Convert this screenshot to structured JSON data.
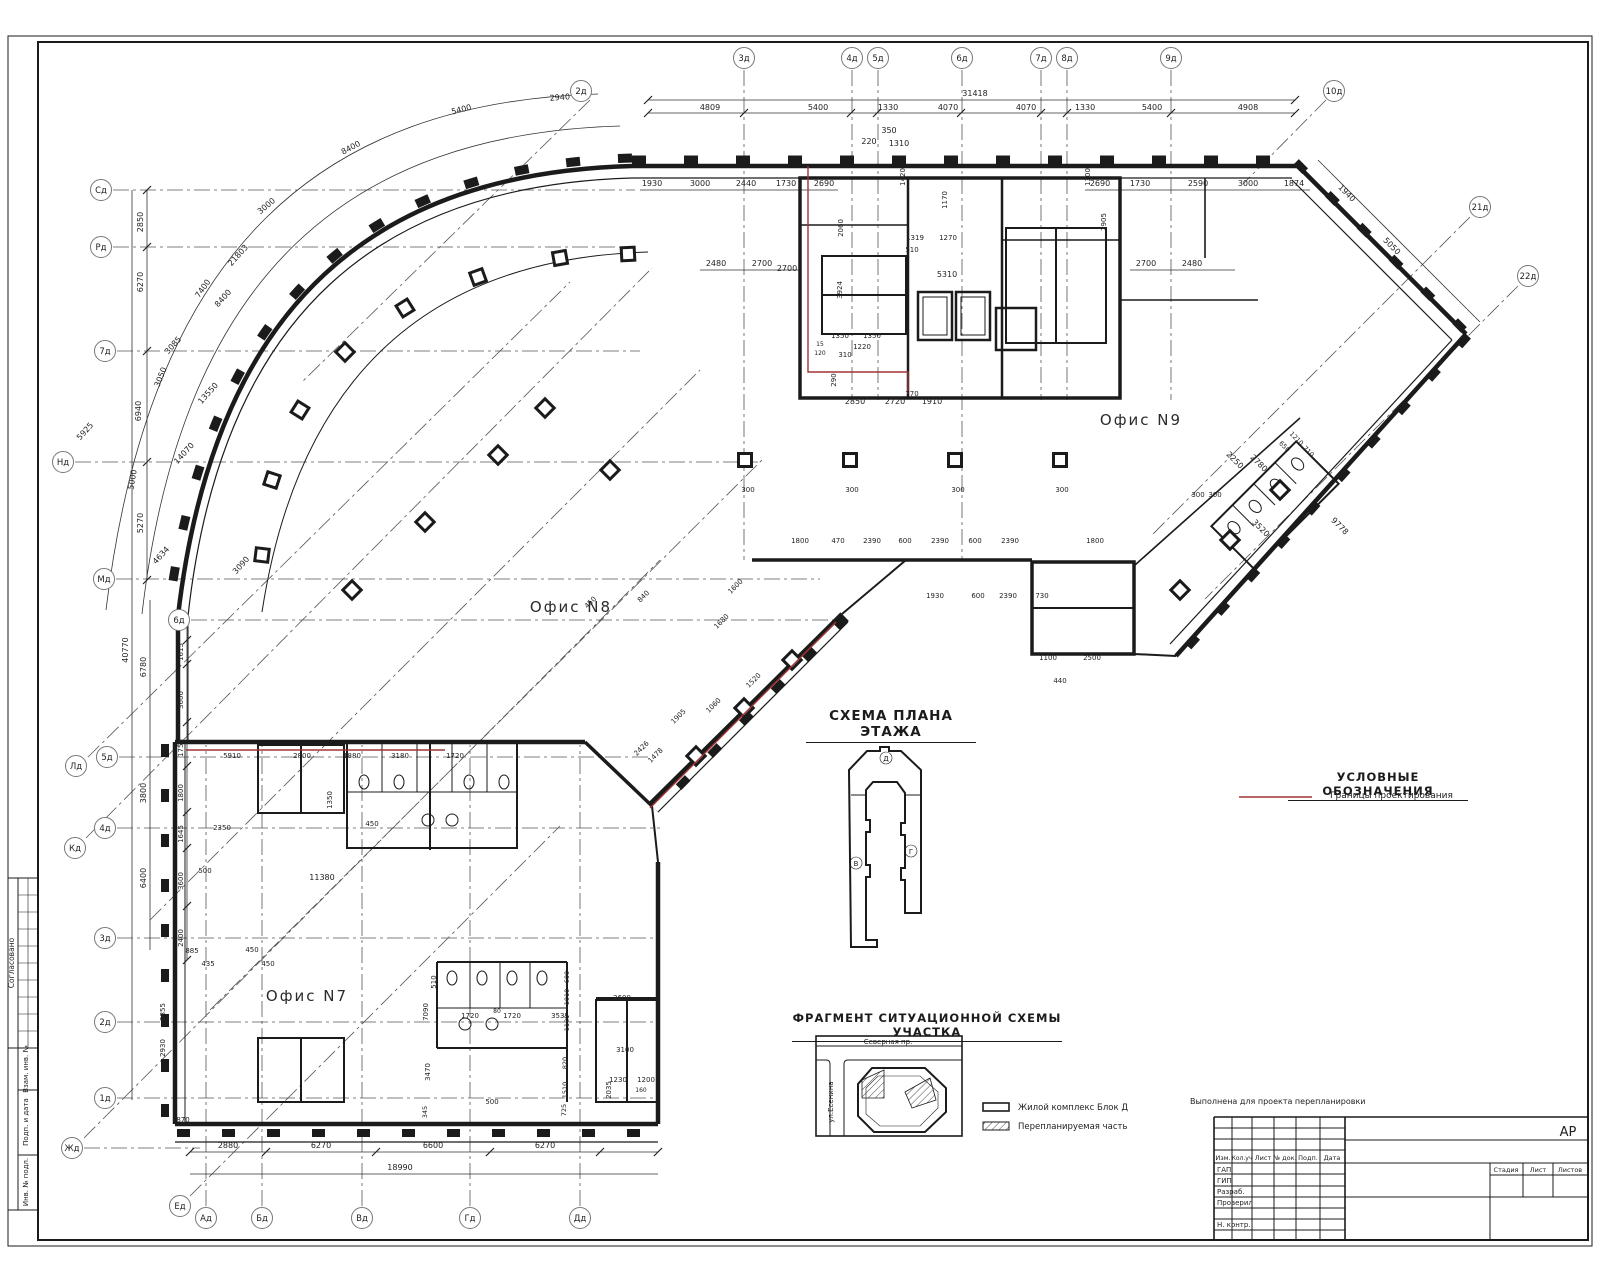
{
  "headings": {
    "scheme": "СХЕМА ПЛАНА ЭТАЖА",
    "legend": "УСЛОВНЫЕ ОБОЗНАЧЕНИЯ",
    "legend_item": "Границы проектирования",
    "fragment": "ФРАГМЕНТ СИТУАЦИОННОЙ СХЕМЫ УЧАСТКА"
  },
  "offices": {
    "n7": "Офис N7",
    "n8": "Офис N8",
    "n9": "Офис N9"
  },
  "map": {
    "street_top": "Северная пр.",
    "street_left": "ул.Есенина",
    "legend_block": "Жилой комплекс Блок Д",
    "legend_hatch": "Перепланируемая часть"
  },
  "title_block": {
    "stage_value": "АР",
    "note": "Выполнена для проекта перепланировки",
    "header": [
      "Изм.",
      "Кол.уч",
      "Лист",
      "№ док.",
      "Подп.",
      "Дата"
    ],
    "rows": [
      "ГАП",
      "ГИП",
      "Разраб.",
      "Проверил",
      "Н. контр."
    ],
    "stage_cols": [
      "Стадия",
      "Лист",
      "Листов"
    ]
  },
  "margin_labels": [
    "Согласовано",
    "Взам. инв. №",
    "Подп. и дата",
    "Инв. № подл."
  ],
  "colors": {
    "boundary_red": "#a03535",
    "ink": "#1b1b1b"
  },
  "plan": {
    "axes": [
      [
        "2д",
        581,
        91
      ],
      [
        "3д",
        744,
        58
      ],
      [
        "4д",
        852,
        58
      ],
      [
        "5д",
        878,
        58
      ],
      [
        "6д",
        962,
        58
      ],
      [
        "7д",
        1041,
        58
      ],
      [
        "8д",
        1067,
        58
      ],
      [
        "9д",
        1171,
        58
      ],
      [
        "10д",
        1334,
        91
      ],
      [
        "21д",
        1480,
        207
      ],
      [
        "22д",
        1528,
        276
      ],
      [
        "Сд",
        101,
        190
      ],
      [
        "Рд",
        101,
        247
      ],
      [
        "7д",
        105,
        351
      ],
      [
        "Нд",
        63,
        462
      ],
      [
        "Мд",
        104,
        579
      ],
      [
        "6д",
        179,
        620
      ],
      [
        "Лд",
        76,
        766
      ],
      [
        "5д",
        107,
        757
      ],
      [
        "4д",
        105,
        828
      ],
      [
        "Кд",
        75,
        848
      ],
      [
        "3д",
        105,
        938
      ],
      [
        "2д",
        105,
        1022
      ],
      [
        "1д",
        105,
        1098
      ],
      [
        "Жд",
        72,
        1148
      ],
      [
        "Ед",
        180,
        1206
      ],
      [
        "Ад",
        206,
        1218
      ],
      [
        "Бд",
        262,
        1218
      ],
      [
        "Вд",
        362,
        1218
      ],
      [
        "Гд",
        470,
        1218
      ],
      [
        "Дд",
        580,
        1218
      ]
    ],
    "labels": [
      [
        975,
        96,
        "31418"
      ],
      [
        710,
        110,
        "4809"
      ],
      [
        818,
        110,
        "5400"
      ],
      [
        888,
        110,
        "1330"
      ],
      [
        948,
        110,
        "4070"
      ],
      [
        1026,
        110,
        "4070"
      ],
      [
        1085,
        110,
        "1330"
      ],
      [
        1152,
        110,
        "5400"
      ],
      [
        1248,
        110,
        "4908"
      ],
      [
        652,
        186,
        "1930"
      ],
      [
        700,
        186,
        "3000"
      ],
      [
        746,
        186,
        "2440"
      ],
      [
        786,
        186,
        "1730"
      ],
      [
        824,
        186,
        "2690"
      ],
      [
        1100,
        186,
        "2690"
      ],
      [
        1140,
        186,
        "1730"
      ],
      [
        1198,
        186,
        "2590"
      ],
      [
        1248,
        186,
        "3000"
      ],
      [
        1294,
        186,
        "1874"
      ],
      [
        869,
        144,
        "220"
      ],
      [
        889,
        133,
        "350"
      ],
      [
        899,
        146,
        "1310"
      ],
      [
        905,
        177,
        "1420",
        -90,
        7
      ],
      [
        947,
        200,
        "1170",
        -90,
        7
      ],
      [
        1090,
        177,
        "1300",
        -90,
        7
      ],
      [
        716,
        266,
        "2480"
      ],
      [
        762,
        266,
        "2700"
      ],
      [
        1146,
        266,
        "2700"
      ],
      [
        1192,
        266,
        "2480"
      ],
      [
        843,
        228,
        "2060",
        -90,
        7
      ],
      [
        915,
        240,
        "1319",
        0,
        7
      ],
      [
        948,
        240,
        "1270",
        0,
        7
      ],
      [
        912,
        252,
        "510",
        0,
        7
      ],
      [
        947,
        277,
        "5310"
      ],
      [
        787,
        271,
        "2700"
      ],
      [
        842,
        290,
        "3924",
        -90,
        7
      ],
      [
        840,
        338,
        "1350",
        0,
        7
      ],
      [
        872,
        338,
        "1350",
        0,
        7
      ],
      [
        862,
        349,
        "1220",
        0,
        7
      ],
      [
        845,
        357,
        "310",
        0,
        7
      ],
      [
        820,
        346,
        "15",
        0,
        6
      ],
      [
        820,
        355,
        "120",
        0,
        6
      ],
      [
        836,
        380,
        "290",
        -90,
        7
      ],
      [
        1106,
        222,
        "2905",
        -90,
        7
      ],
      [
        855,
        404,
        "2850"
      ],
      [
        895,
        404,
        "2720"
      ],
      [
        932,
        404,
        "1910"
      ],
      [
        912,
        396,
        "770",
        0,
        7
      ],
      [
        800,
        543,
        "1800",
        0,
        7
      ],
      [
        838,
        543,
        "470",
        0,
        7
      ],
      [
        872,
        543,
        "2390",
        0,
        7
      ],
      [
        905,
        543,
        "600",
        0,
        7
      ],
      [
        940,
        543,
        "2390",
        0,
        7
      ],
      [
        975,
        543,
        "600",
        0,
        7
      ],
      [
        1010,
        543,
        "2390",
        0,
        7
      ],
      [
        1095,
        543,
        "1800",
        0,
        7
      ],
      [
        935,
        598,
        "1930",
        0,
        7
      ],
      [
        978,
        598,
        "600",
        0,
        7
      ],
      [
        1008,
        598,
        "2390",
        0,
        7
      ],
      [
        1042,
        598,
        "730",
        0,
        7
      ],
      [
        1048,
        660,
        "1100",
        0,
        7
      ],
      [
        1092,
        660,
        "2500",
        0,
        7
      ],
      [
        1060,
        683,
        "440",
        0,
        7
      ],
      [
        748,
        492,
        "300",
        0,
        7
      ],
      [
        852,
        492,
        "300",
        0,
        7
      ],
      [
        958,
        492,
        "300",
        0,
        7
      ],
      [
        1062,
        492,
        "300",
        0,
        7
      ],
      [
        143,
        222,
        "2850",
        -90
      ],
      [
        143,
        282,
        "6270",
        -90
      ],
      [
        141,
        411,
        "6940",
        -90
      ],
      [
        143,
        523,
        "5270",
        -90
      ],
      [
        128,
        650,
        "40770",
        -90
      ],
      [
        146,
        667,
        "6780",
        -90
      ],
      [
        146,
        793,
        "3800",
        -90
      ],
      [
        146,
        878,
        "6400",
        -90
      ],
      [
        183,
        652,
        "1615",
        -90,
        7
      ],
      [
        183,
        700,
        "3600",
        -90,
        7
      ],
      [
        183,
        748,
        "1755",
        -90,
        7
      ],
      [
        183,
        793,
        "1800",
        -90,
        7
      ],
      [
        183,
        834,
        "1645",
        -90,
        7
      ],
      [
        183,
        881,
        "3600",
        -90,
        7
      ],
      [
        183,
        938,
        "2400",
        -90,
        7
      ],
      [
        165,
        1012,
        "2855",
        -90,
        7
      ],
      [
        165,
        1048,
        "2930",
        -90,
        7
      ],
      [
        240,
        257,
        "21803",
        -48
      ],
      [
        225,
        300,
        "8400",
        -48
      ],
      [
        175,
        347,
        "3085",
        -48
      ],
      [
        210,
        395,
        "13550",
        -48
      ],
      [
        186,
        455,
        "14070",
        -48
      ],
      [
        163,
        557,
        "4634",
        -48
      ],
      [
        243,
        567,
        "3090",
        -48
      ],
      [
        87,
        433,
        "5925",
        -48
      ],
      [
        560,
        100,
        "2940",
        -4
      ],
      [
        462,
        112,
        "5400",
        -14
      ],
      [
        352,
        150,
        "8400",
        -28
      ],
      [
        268,
        208,
        "3000",
        -40
      ],
      [
        205,
        290,
        "7400",
        -55
      ],
      [
        163,
        378,
        "3050",
        -68
      ],
      [
        135,
        480,
        "5000",
        -80
      ],
      [
        592,
        604,
        "450",
        -45,
        7
      ],
      [
        645,
        598,
        "840",
        -45,
        7
      ],
      [
        737,
        588,
        "1600",
        -45,
        7
      ],
      [
        723,
        623,
        "1680",
        -45,
        7
      ],
      [
        755,
        682,
        "1520",
        -45,
        7
      ],
      [
        715,
        707,
        "1060",
        -45,
        7
      ],
      [
        680,
        718,
        "1905",
        -45,
        7
      ],
      [
        643,
        750,
        "2426",
        -45,
        7
      ],
      [
        657,
        757,
        "1478",
        -45,
        7
      ],
      [
        1345,
        195,
        "1940",
        45
      ],
      [
        1390,
        248,
        "5050",
        45
      ],
      [
        1338,
        528,
        "9778",
        45
      ],
      [
        1257,
        465,
        "2780",
        45
      ],
      [
        1259,
        530,
        "3520",
        45
      ],
      [
        1233,
        462,
        "2250",
        45
      ],
      [
        1283,
        448,
        "650",
        45,
        6.5
      ],
      [
        1295,
        440,
        "1210",
        45,
        6.5
      ],
      [
        1307,
        453,
        "710",
        45,
        6.5
      ],
      [
        1198,
        497,
        "300",
        0,
        7
      ],
      [
        1215,
        497,
        "300",
        0,
        7
      ],
      [
        232,
        758,
        "5910",
        0,
        7
      ],
      [
        302,
        758,
        "2800",
        0,
        7
      ],
      [
        352,
        758,
        "1880",
        0,
        7
      ],
      [
        400,
        758,
        "3180",
        0,
        7
      ],
      [
        455,
        758,
        "1720",
        0,
        7
      ],
      [
        222,
        830,
        "2350",
        0,
        7
      ],
      [
        372,
        826,
        "450",
        0,
        7
      ],
      [
        332,
        800,
        "1350",
        -90,
        7
      ],
      [
        205,
        873,
        "500",
        0,
        7
      ],
      [
        322,
        880,
        "11380"
      ],
      [
        192,
        953,
        "885",
        0,
        7
      ],
      [
        208,
        966,
        "435",
        0,
        7
      ],
      [
        252,
        952,
        "450",
        0,
        7
      ],
      [
        268,
        966,
        "450",
        0,
        7
      ],
      [
        470,
        1018,
        "1720",
        0,
        7
      ],
      [
        497,
        1013,
        "80",
        0,
        6
      ],
      [
        512,
        1018,
        "1720",
        0,
        7
      ],
      [
        560,
        1018,
        "3535",
        0,
        7
      ],
      [
        622,
        1000,
        "2600",
        0,
        7
      ],
      [
        625,
        1052,
        "3100",
        0,
        7
      ],
      [
        618,
        1082,
        "1230",
        0,
        7
      ],
      [
        646,
        1082,
        "1200",
        0,
        7
      ],
      [
        641,
        1092,
        "160",
        0,
        6
      ],
      [
        611,
        1090,
        "2035",
        -90,
        7
      ],
      [
        492,
        1104,
        "500",
        0,
        7
      ],
      [
        436,
        982,
        "510",
        -90,
        7
      ],
      [
        428,
        1012,
        "7090",
        -90,
        7
      ],
      [
        430,
        1072,
        "3470",
        -90,
        7
      ],
      [
        427,
        1112,
        "345",
        -90,
        6.5
      ],
      [
        569,
        977,
        "600",
        -90,
        6.5
      ],
      [
        569,
        997,
        "1010",
        -90,
        6.5
      ],
      [
        569,
        1023,
        "1180",
        -90,
        6.5
      ],
      [
        567,
        1063,
        "820",
        -90,
        6.5
      ],
      [
        567,
        1090,
        "1510",
        -90,
        6.5
      ],
      [
        566,
        1110,
        "725",
        -90,
        6.5
      ],
      [
        183,
        1122,
        "870",
        0,
        7
      ],
      [
        228,
        1148,
        "2880"
      ],
      [
        321,
        1148,
        "6270"
      ],
      [
        433,
        1148,
        "6600"
      ],
      [
        545,
        1148,
        "6270"
      ],
      [
        400,
        1170,
        "18990"
      ],
      [
        886,
        761,
        "Д",
        0,
        7
      ],
      [
        856,
        866,
        "В",
        0,
        7
      ],
      [
        911,
        854,
        "Г",
        0,
        7
      ],
      [
        888,
        1044,
        "Северная пр.",
        0,
        7
      ],
      [
        833,
        1102,
        "ул.Есенина",
        -90,
        7
      ],
      [
        1018,
        1110,
        "Жилой комплекс Блок Д",
        0,
        8.5,
        "start"
      ],
      [
        1018,
        1129,
        "Перепланируемая часть",
        0,
        8.5,
        "start"
      ],
      [
        14,
        963,
        "Согласовано",
        -90,
        7.5
      ],
      [
        28,
        1069,
        "Взам. инв. №",
        -90,
        7
      ],
      [
        28,
        1122,
        "Подп. и дата",
        -90,
        7
      ],
      [
        28,
        1182,
        "Инв. № подл.",
        -90,
        7
      ],
      [
        1223,
        1160,
        "Изм.",
        0,
        6.5
      ],
      [
        1242,
        1160,
        "Кол.уч",
        0,
        6
      ],
      [
        1263,
        1160,
        "Лист",
        0,
        6.5
      ],
      [
        1285,
        1160,
        "№ док.",
        0,
        6.5
      ],
      [
        1308,
        1160,
        "Подп.",
        0,
        6.5
      ],
      [
        1332,
        1160,
        "Дата",
        0,
        6.5
      ],
      [
        1217,
        1172,
        "ГАП",
        0,
        7,
        "start"
      ],
      [
        1217,
        1183,
        "ГИП",
        0,
        7,
        "start"
      ],
      [
        1217,
        1194,
        "Разраб.",
        0,
        7,
        "start"
      ],
      [
        1217,
        1205,
        "Проверил",
        0,
        7,
        "start"
      ],
      [
        1217,
        1227,
        "Н. контр.",
        0,
        7,
        "start"
      ],
      [
        1506,
        1172,
        "Стадия",
        0,
        6.5
      ],
      [
        1538,
        1172,
        "Лист",
        0,
        6.5
      ],
      [
        1570,
        1172,
        "Листов",
        0,
        6.5
      ],
      [
        1568,
        1136,
        "АР",
        0,
        13
      ],
      [
        1190,
        1104,
        "Выполнена для проекта перепланировки",
        0,
        8,
        "start"
      ]
    ]
  }
}
